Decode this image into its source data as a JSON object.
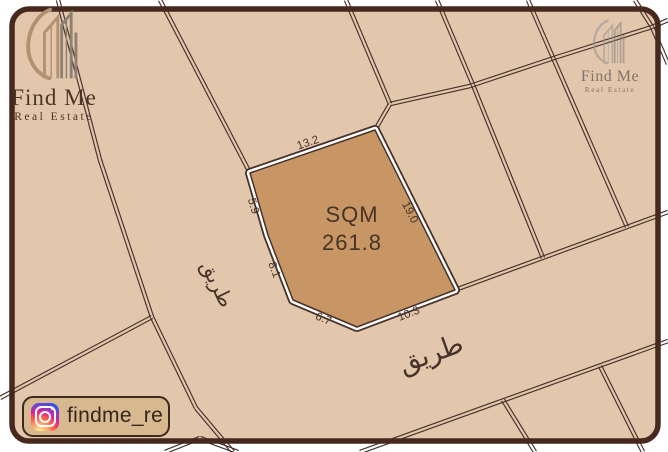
{
  "brand": {
    "name": "Find Me",
    "tagline": "Real Estate",
    "instagram_handle": "findme_re"
  },
  "map": {
    "background": "#e3c7ac",
    "line_color": "#46322a",
    "frame_color": "#46281f",
    "dim_color": "#463426",
    "frame": {
      "x": 12,
      "y": 9,
      "w": 646,
      "h": 432,
      "r": 17
    },
    "lines": [
      [
        [
          58,
          0
        ],
        [
          100,
          160
        ],
        [
          152,
          317
        ],
        [
          196,
          408
        ],
        [
          233,
          452
        ]
      ],
      [
        [
          152,
          317
        ],
        [
          0,
          398
        ]
      ],
      [
        [
          165,
          452
        ],
        [
          200,
          438
        ],
        [
          238,
          452
        ]
      ],
      [
        [
          160,
          0
        ],
        [
          250,
          173
        ]
      ],
      [
        [
          346,
          0
        ],
        [
          390,
          104
        ]
      ],
      [
        [
          375,
          130
        ],
        [
          390,
          104
        ],
        [
          470,
          86
        ],
        [
          557,
          57
        ],
        [
          652,
          27
        ],
        [
          668,
          20
        ]
      ],
      [
        [
          437,
          0
        ],
        [
          473,
          85
        ]
      ],
      [
        [
          473,
          85
        ],
        [
          543,
          258
        ]
      ],
      [
        [
          528,
          0
        ],
        [
          554,
          60
        ]
      ],
      [
        [
          554,
          60
        ],
        [
          627,
          227
        ]
      ],
      [
        [
          635,
          0
        ],
        [
          652,
          27
        ],
        [
          668,
          64
        ]
      ],
      [
        [
          455,
          290
        ],
        [
          668,
          212
        ]
      ],
      [
        [
          360,
          452
        ],
        [
          668,
          341
        ]
      ],
      [
        [
          503,
          400
        ],
        [
          535,
          452
        ]
      ],
      [
        [
          600,
          366
        ],
        [
          643,
          452
        ]
      ]
    ],
    "plot": {
      "fill": "#c89664",
      "vertices": [
        [
          375,
          130
        ],
        [
          455,
          290
        ],
        [
          357,
          327
        ],
        [
          293,
          300
        ],
        [
          268,
          235
        ],
        [
          250,
          173
        ]
      ],
      "area_label": "SQM",
      "area_value": "261.8",
      "area_label_pos": [
        352,
        222
      ],
      "area_value_pos": [
        352,
        250
      ],
      "area_font_size": 22,
      "edge_labels": [
        {
          "text": "13.2",
          "x": 309,
          "y": 146,
          "rot": -19
        },
        {
          "text": "19.0",
          "x": 407,
          "y": 214,
          "rot": 63
        },
        {
          "text": "10.3",
          "x": 410,
          "y": 317,
          "rot": -21
        },
        {
          "text": "6.7",
          "x": 322,
          "y": 322,
          "rot": 23
        },
        {
          "text": "8.1",
          "x": 271,
          "y": 271,
          "rot": 69
        },
        {
          "text": "5.9",
          "x": 250,
          "y": 207,
          "rot": 74
        }
      ],
      "edge_font_size": 11.5
    },
    "road_labels": [
      {
        "text": "طريق",
        "x": 211,
        "y": 287,
        "rot": 64,
        "size": 20
      },
      {
        "text": "طريق",
        "x": 434,
        "y": 362,
        "rot": -20,
        "size": 27
      }
    ]
  }
}
